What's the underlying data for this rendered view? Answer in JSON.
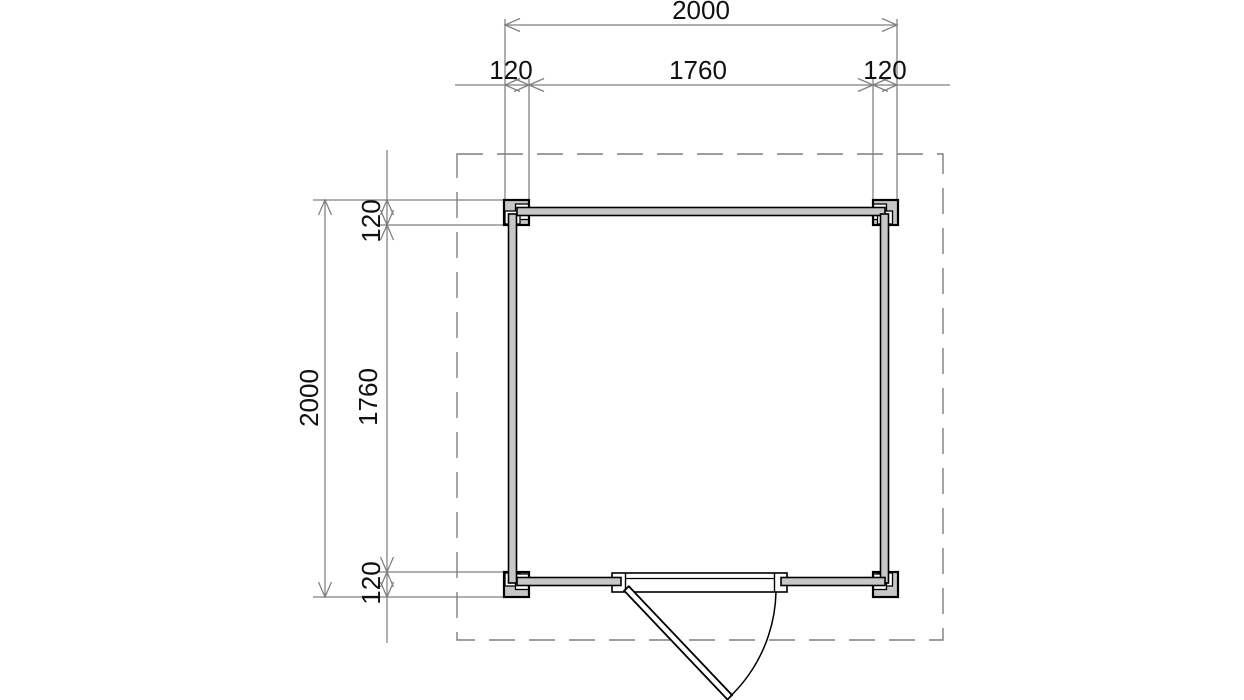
{
  "drawing": {
    "type": "floor-plan",
    "colors": {
      "wall_fill": "#c7c7c7",
      "outline_black": "#000000",
      "dimension_gray": "#7f7f7f",
      "text_color": "#111111",
      "background": "#ffffff"
    }
  },
  "dims": {
    "top": {
      "overall": "2000",
      "left_offset": "120",
      "middle": "1760",
      "right_offset": "120"
    },
    "left": {
      "overall": "2000",
      "top_offset": "120",
      "middle": "1760",
      "bottom_offset": "120"
    }
  }
}
